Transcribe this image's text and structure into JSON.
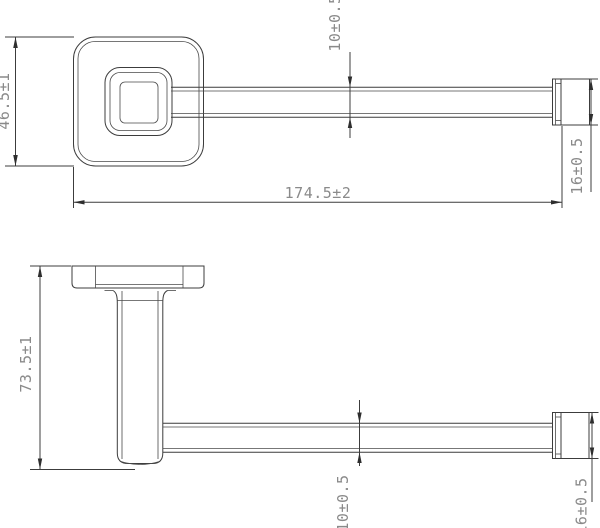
{
  "drawing": {
    "title": "wall-mounted bar holder technical drawing",
    "background_color": "#ffffff",
    "line_color": "#3c3c3c",
    "dimension_text_color": "#8a8a8a",
    "top_view": {
      "dim_plate_size": "46.5±1",
      "dim_bar_thickness": "10±0.5",
      "dim_overall_length": "174.5±2",
      "dim_end_cap_size": "16±0.5"
    },
    "side_view": {
      "dim_overall_depth": "73.5±1",
      "dim_bar_thickness": "10±0.5",
      "dim_end_cap_size": "16±0.5"
    }
  }
}
